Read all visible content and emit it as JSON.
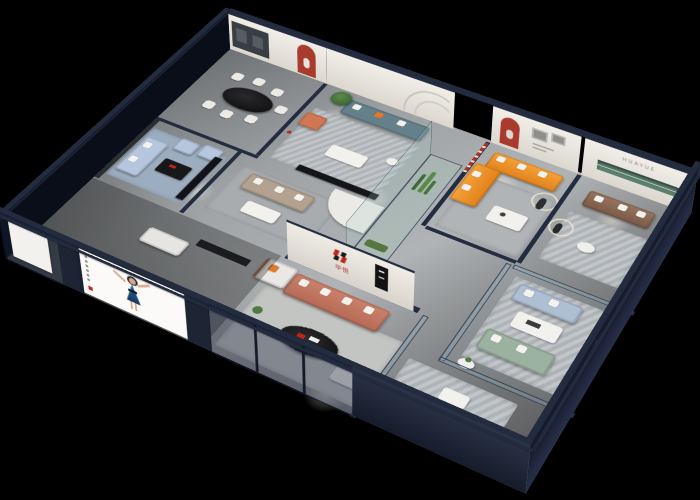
{
  "scene": {
    "description": "3D isometric cutaway render of a furniture showroom interior viewed from above at night",
    "background_color": "#000000",
    "brand": {
      "name_cn": "华悦",
      "wall_lettering": "HUAYUE",
      "logo_mark": "red and black angled-bar monogram",
      "logo_colors": [
        "#c6231c",
        "#1a1a1a"
      ]
    },
    "palette": {
      "exterior_wall": "#1d2434",
      "wall_cap": "#232b3e",
      "interior_wall": "#ece9e3",
      "floor": "#a3a7aa",
      "accent_red": "#a83a2e",
      "orange_sofa": "#ef9226",
      "coral_sofa": "#c0735e",
      "teal_sofa": "#64808a",
      "blue_sofa": "#b6c6df",
      "green_sofa": "#9cb2a1",
      "brown_sofa": "#8a6a57",
      "poster_dress_blue": "#1c4f7d",
      "glass": "#96becd"
    },
    "rooms": [
      {
        "id": "dining-room",
        "label": "Dining area",
        "items": [
          "black oval marble dining table",
          "six white upholstered chairs",
          "red arched wall niche",
          "dark gallery wall with framed art"
        ]
      },
      {
        "id": "teal-lounge",
        "label": "Teal sofa lounge",
        "items": [
          "teal three-seat sofa with white and orange pillows",
          "coral accent armchair",
          "potted green tree",
          "white coffee table",
          "black media console",
          "red floor lamp",
          "curved-line wall mural"
        ]
      },
      {
        "id": "orange-lounge",
        "label": "Orange sectional lounge",
        "items": [
          "orange L-shaped sectional sofa with white pillows",
          "white coffee table with tableware",
          "red arched niche with figurine",
          "framed wall art",
          "running-figure sculpture with ring light",
          "red-and-white striped wall ribbon"
        ]
      },
      {
        "id": "huayue-lounge",
        "label": "HUAYUE brand lounge",
        "items": [
          "brown leather sofa with white pillows",
          "HUAYUE wall lettering",
          "recessed green display shelf",
          "standing figure sculpture with circular backlight",
          "round white side table"
        ]
      },
      {
        "id": "blue-living-room",
        "label": "Blue sofa living room",
        "items": [
          "light blue fabric sofa",
          "two light blue armchairs",
          "black coffee table with red accent",
          "black media console",
          "blue-grey area rug"
        ]
      },
      {
        "id": "center-display",
        "label": "Centre display area",
        "items": [
          "taupe fabric sofa",
          "white coffee table",
          "curved white reception partition",
          "glass plant column with cacti",
          "terracotta figure sculpture"
        ]
      },
      {
        "id": "east-glass-room",
        "label": "Glass-walled sofa gallery",
        "items": [
          "light blue sofa",
          "sage green sofa with white pillows",
          "white display table",
          "glass partition walls",
          "round side table with plant"
        ]
      },
      {
        "id": "front-showroom",
        "label": "Front showroom",
        "items": [
          "brand logo wall with red-black monogram",
          "coral sofa with white cushions",
          "white sofa with wood frame and orange cushion",
          "black oval coffee table with red decor",
          "white ottoman",
          "floor plant"
        ]
      },
      {
        "id": "front-right-display",
        "label": "Front right display",
        "items": [
          "white fabric sofa",
          "striped area rug",
          "small white side table"
        ]
      }
    ],
    "exterior": {
      "items": [
        "dark navy exterior shell walls with cutaway tops",
        "glass storefront panels",
        "large poster of a woman in a blue dress",
        "blank white display panel",
        "ceiling spotlights pooling on grey floor"
      ]
    },
    "illegible_text": [
      "two-line grey wall slogan above the orange sofa",
      "vertical tagline column on the woman poster"
    ]
  }
}
